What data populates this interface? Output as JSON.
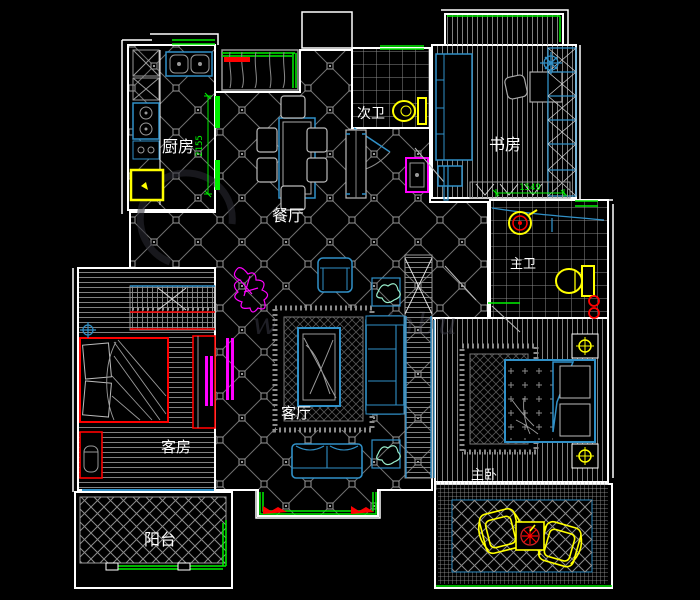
{
  "plan": {
    "type": "residential-floor-plan",
    "background": "#000000",
    "rooms": {
      "kitchen": {
        "label": "厨房"
      },
      "dining": {
        "label": "餐厅"
      },
      "second_bath": {
        "label": "次卫"
      },
      "study": {
        "label": "书房"
      },
      "master_bath": {
        "label": "主卫"
      },
      "living": {
        "label": "客厅"
      },
      "guest_room": {
        "label": "客房"
      },
      "master_bedroom": {
        "label": "主卧"
      },
      "balcony_south": {
        "label": "阳台"
      }
    },
    "dimensions": {
      "kitchen_opening": "2155",
      "study_cabinet": "1549"
    },
    "watermark": {
      "text": "www.js-jnbu"
    },
    "colors": {
      "wall": "#ffffff",
      "tile_line": "#8a8a8a",
      "furniture_blue": "#3090c7",
      "window_green": "#00ef00",
      "accent_red": "#ff0000",
      "fixture_yellow": "#ffff00",
      "accent_magenta": "#ff00ff"
    }
  }
}
